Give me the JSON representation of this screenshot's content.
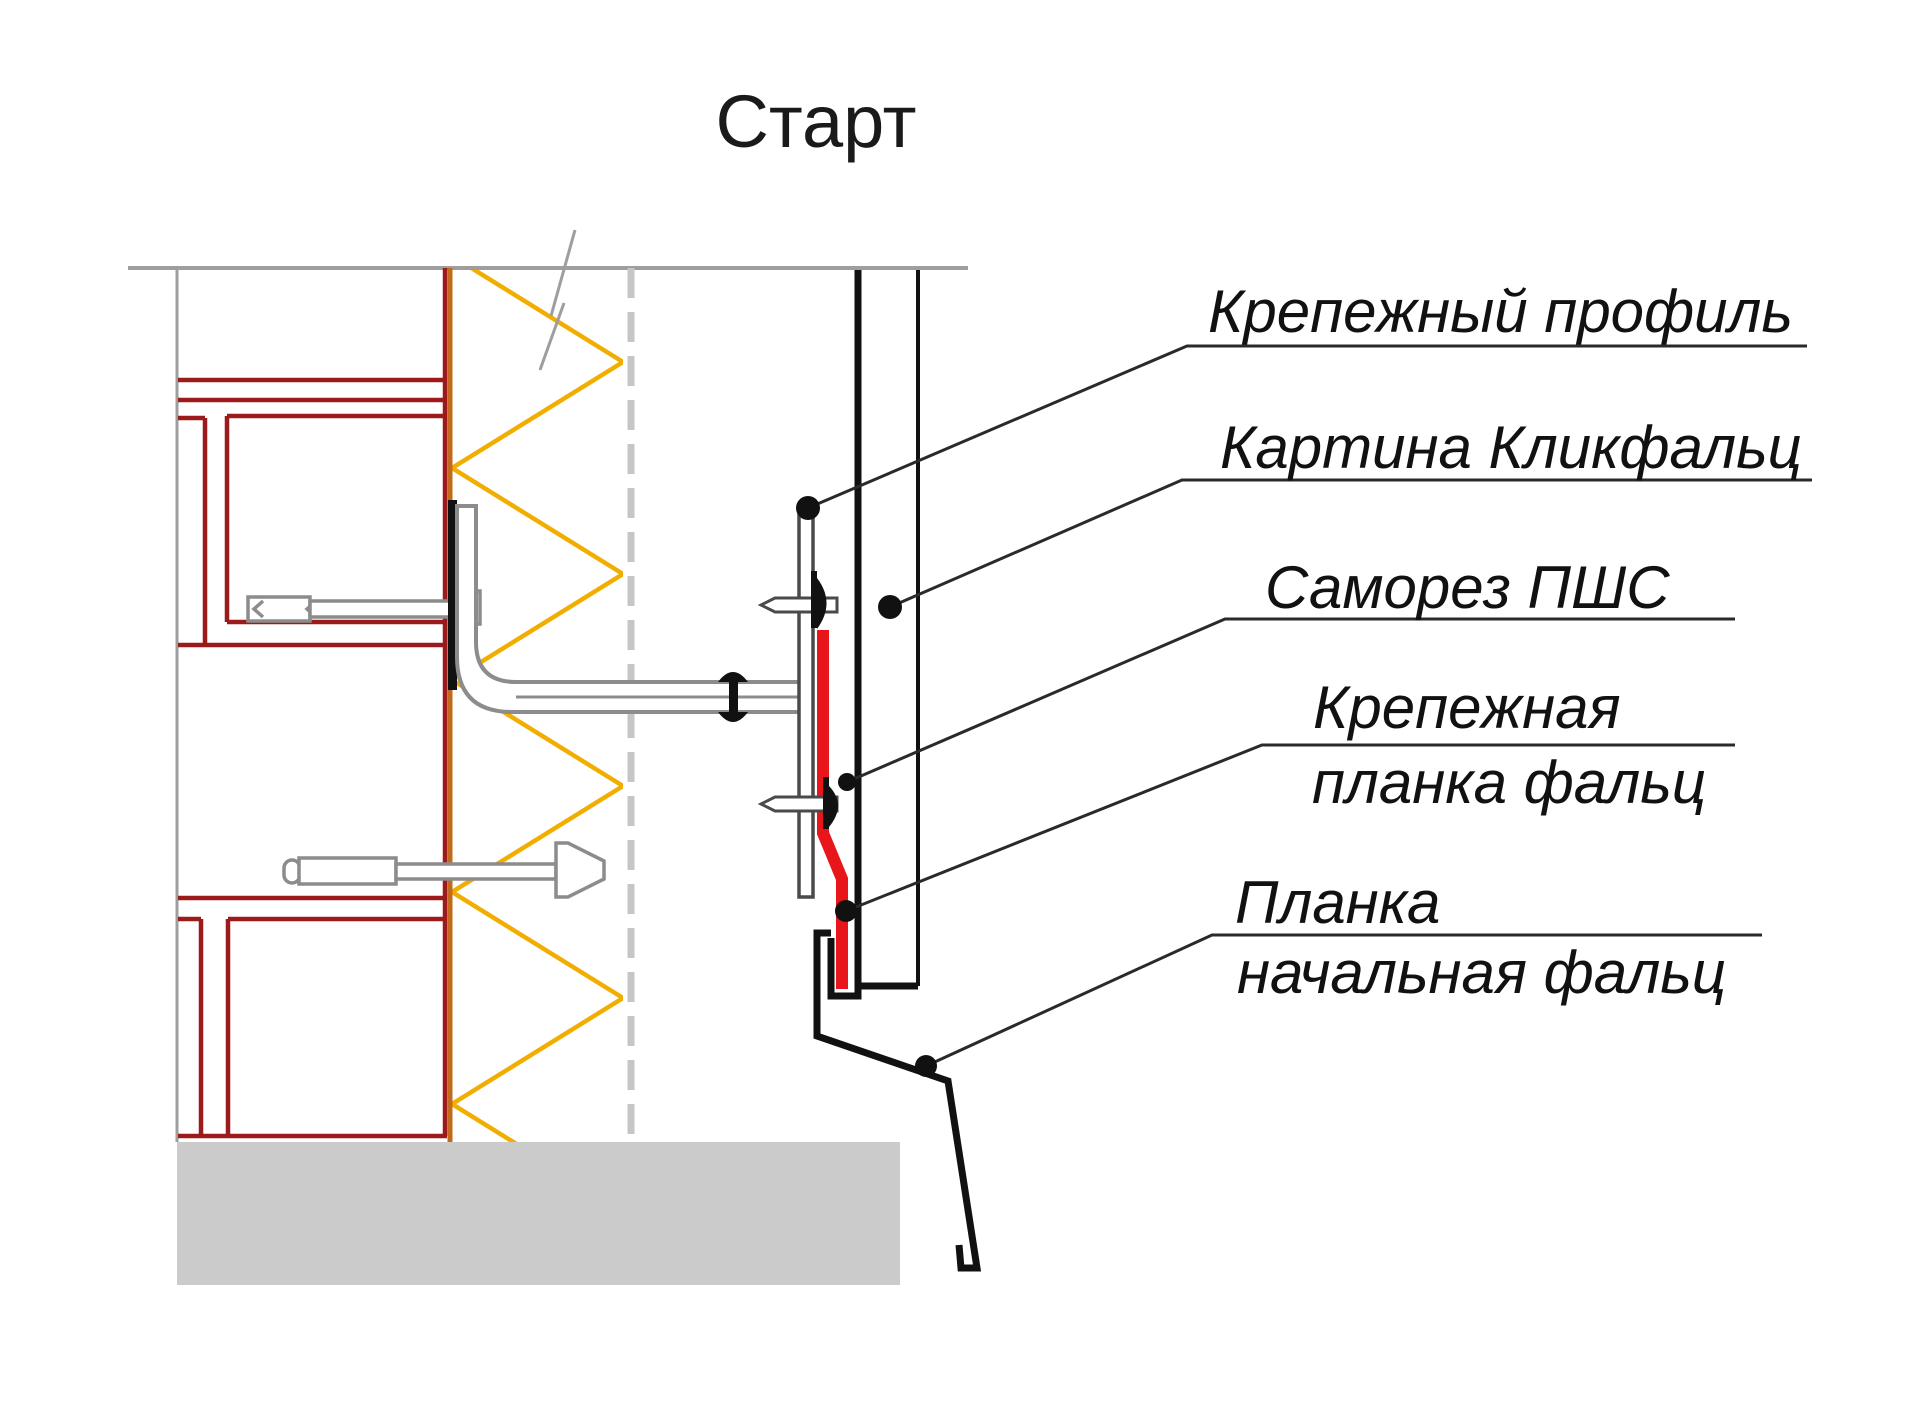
{
  "title": "Старт",
  "labels": {
    "fastening_profile": "Крепежный профиль",
    "click_falz_panel": "Картина Кликфальц",
    "self_tapping_screw": "Саморез ПШС",
    "fastening_strip_line1": "Крепежная",
    "fastening_strip_line2": "планка фальц",
    "starting_strip_line1": "Планка",
    "starting_strip_line2": "начальная фальц"
  },
  "colors": {
    "frame_red": "#9B1B1B",
    "sheathing_orange": "#C2691B",
    "insulation_yellow": "#F2AE00",
    "strip_red": "#E8151B",
    "drawing_gray": "#9E9E9E",
    "steel_gray": "#8C8C8C",
    "dark_line": "#4A4A4A",
    "membrane_gray": "#C6C6C6",
    "foundation_gray": "#CBCBCB",
    "ink_black": "#111111",
    "text_black": "#1A1A1A"
  }
}
